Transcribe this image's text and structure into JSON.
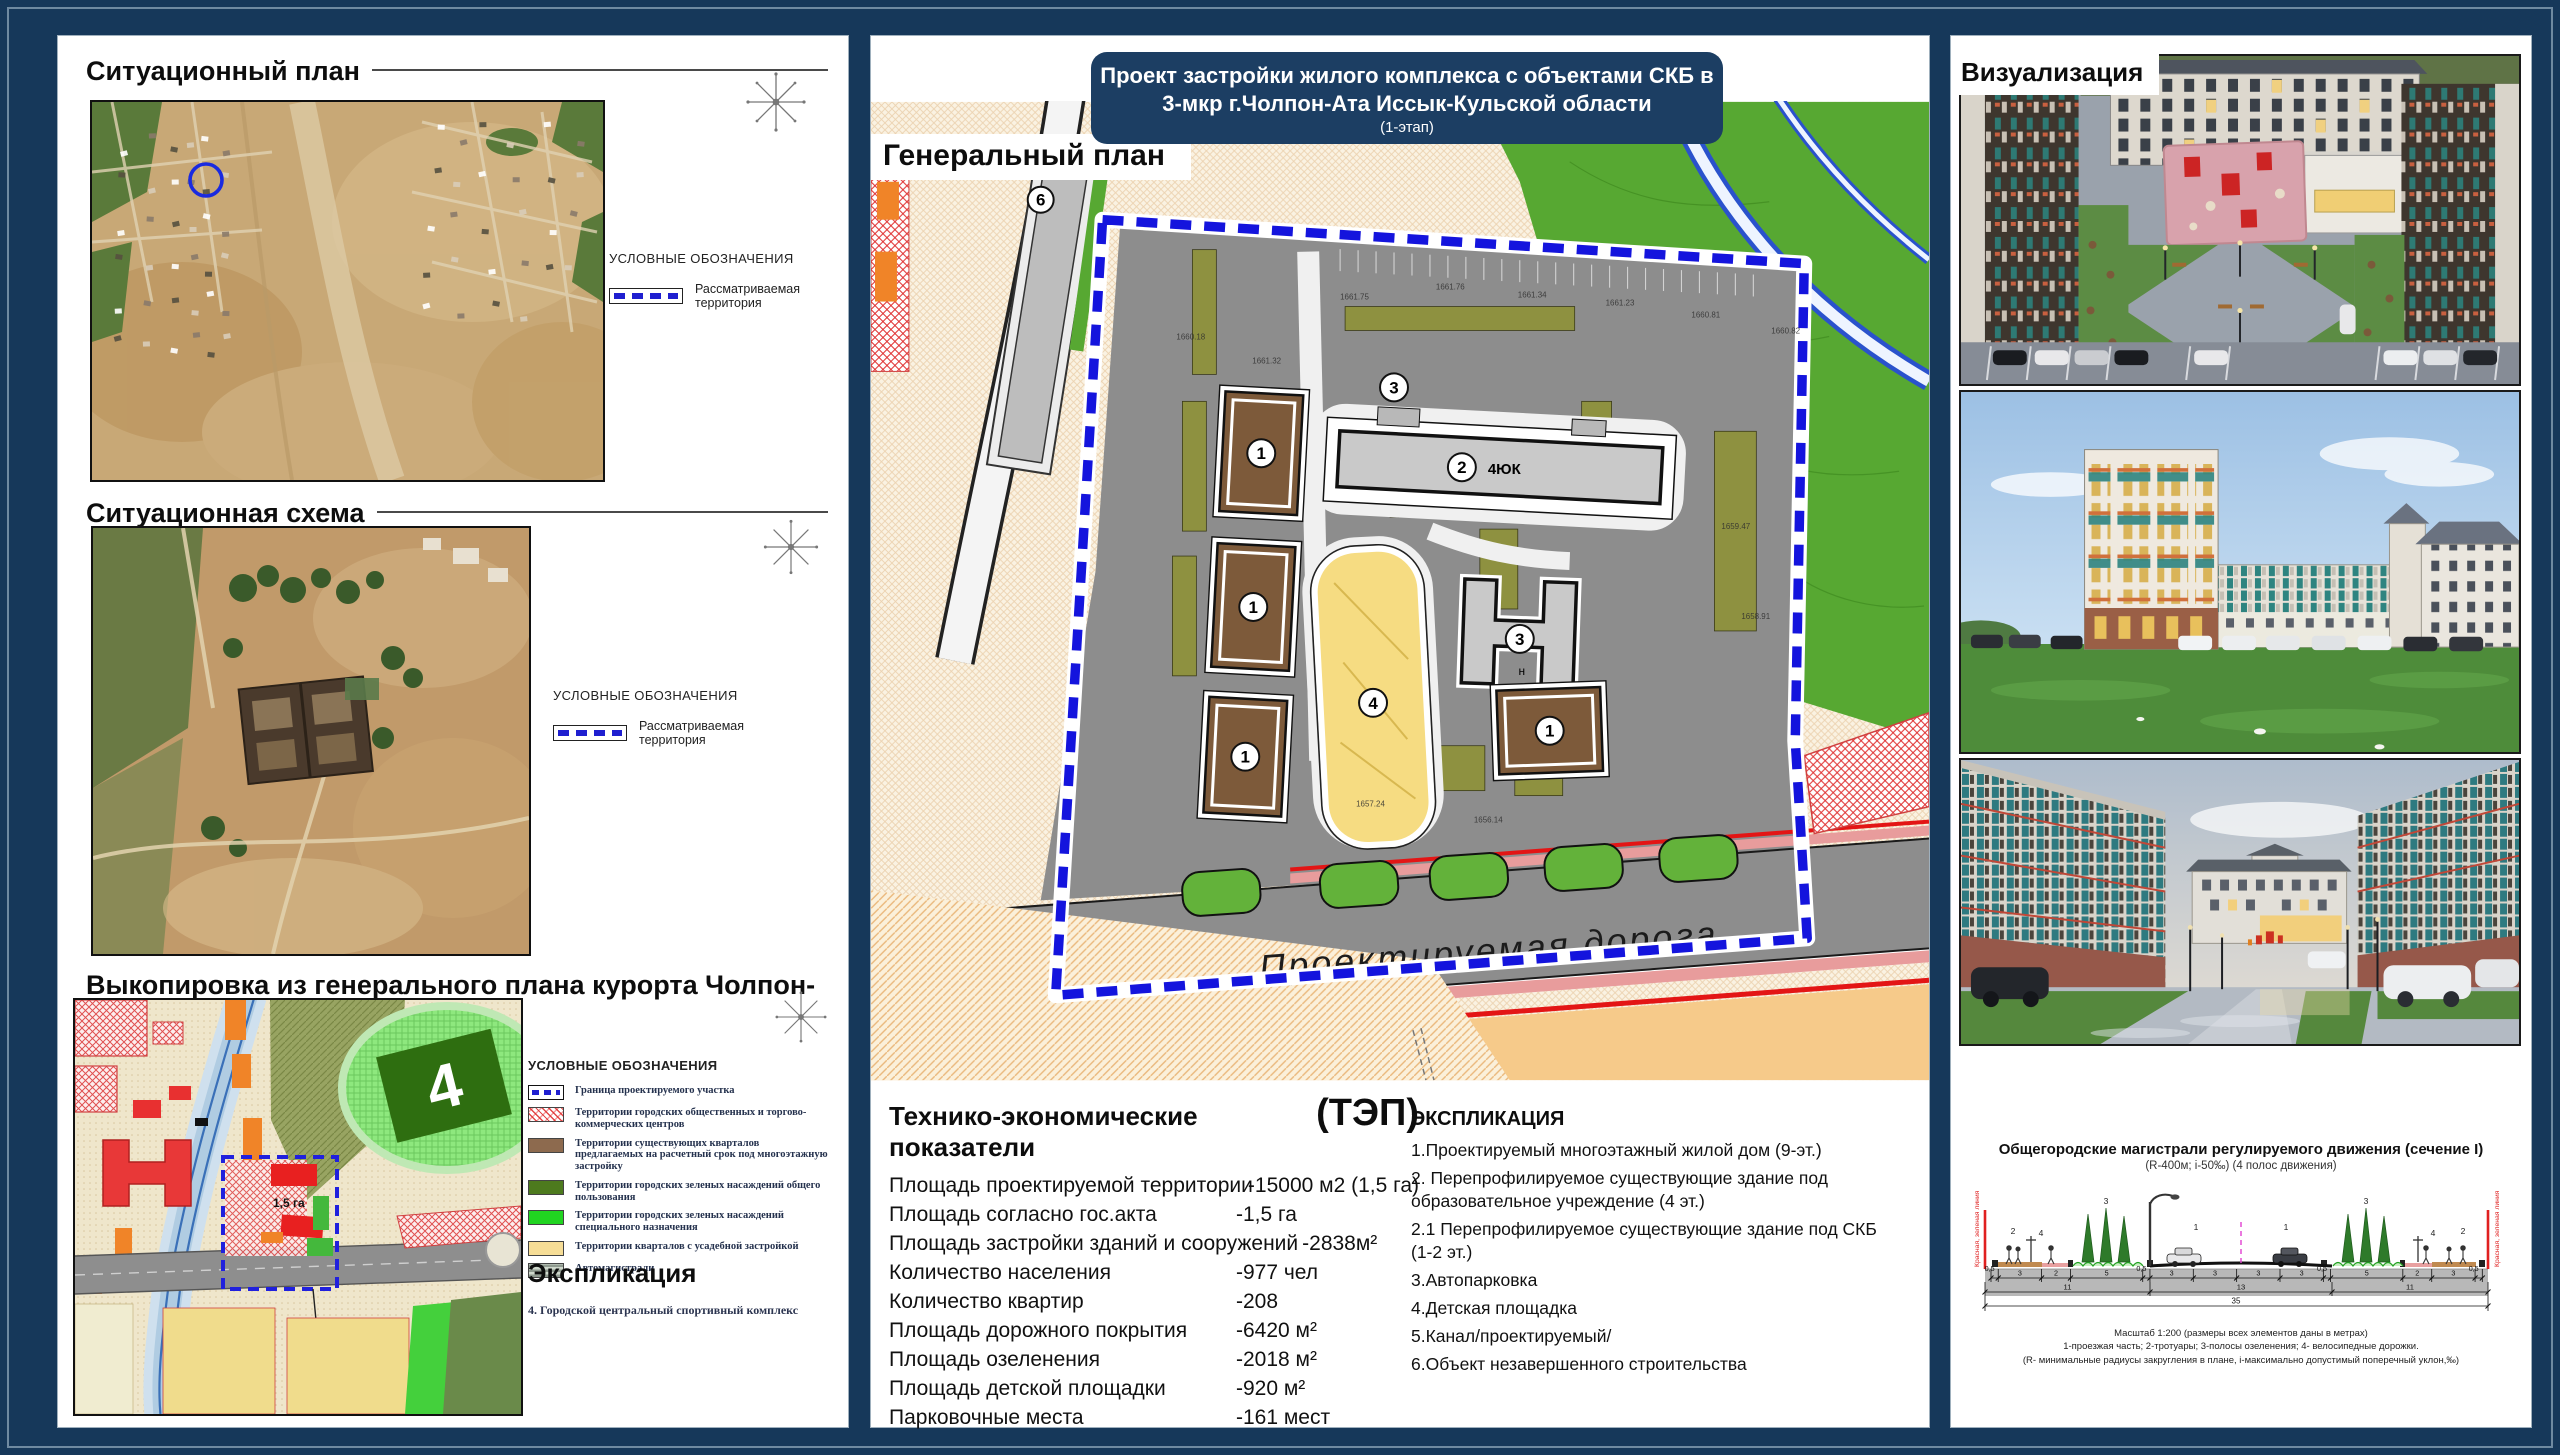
{
  "colors": {
    "board_bg": "#16385a",
    "title_bg": "#1c3e63",
    "boundary_blue": "#1a1add",
    "red_line": "#e31515",
    "site_gray": "#8d8d8d",
    "green_zone": "#57a832",
    "building_brown": "#7d5a3a",
    "playground_yellow": "#f6dc82"
  },
  "left": {
    "situational_plan": {
      "title": "Ситуационный план",
      "legend_title": "УСЛОВНЫЕ ОБОЗНАЧЕНИЯ",
      "legend_item": "Рассматриваемая территория"
    },
    "situational_scheme": {
      "title": "Ситуационная схема",
      "legend_title": "УСЛОВНЫЕ ОБОЗНАЧЕНИЯ",
      "legend_item": "Рассматриваемая территория"
    },
    "master_plan_extract": {
      "title": "Выкопировка из генерального плана курорта Чолпон-Ата",
      "legend_title": "УСЛОВНЫЕ  ОБОЗНАЧЕНИЯ",
      "legend_items": [
        {
          "swatch": "boundary",
          "label": "Граница проектируемого участка"
        },
        {
          "swatch": "red-hatch",
          "label": "Территории городских общественных и торгово-коммерческих центров"
        },
        {
          "swatch": "brown",
          "label": "Территории существующих кварталов предлагаемых на расчетный срок под многоэтажную застройку"
        },
        {
          "swatch": "dark-green",
          "label": "Территории городских зеленых насаждений общего пользования"
        },
        {
          "swatch": "bright-green",
          "label": "Территории городских зеленых насаждений специального назначения"
        },
        {
          "swatch": "pale-yellow",
          "label": "Территории кварталов с усадебной застройкой"
        },
        {
          "swatch": "highway",
          "label": "Автомагистрали"
        }
      ],
      "explication_title": "Экспликация",
      "explication_item": "4.  Городской центральный спортивный комплекс",
      "stadium_number": "4",
      "site_area_label": "1,5 га"
    }
  },
  "center": {
    "title": {
      "line1": "Проект застройки жилого комплекса с объектами СКБ в",
      "line2": "3-мкр г.Чолпон-Ата  Иссык-Кульской области",
      "line3": "(1-этап)"
    },
    "plan_label": "Генеральный план",
    "plan": {
      "road_label": "Проектируемая  дорога",
      "b1": "1",
      "b2": "2",
      "b2_wing": "4ЮК",
      "b3": "3",
      "b3_note": "н",
      "b4": "4",
      "b6": "6",
      "point_a": "А",
      "elevation_marks": [
        "1661.75",
        "1661.76",
        "1661.34",
        "1661.23",
        "1660.81",
        "1660.82",
        "1660.18",
        "1661.32",
        "1659.47",
        "1658.91",
        "1657.24",
        "1656.14"
      ]
    },
    "tep": {
      "title": "Технико-экономические показатели",
      "abbr": "(ТЭП)",
      "rows": [
        {
          "label": "Площадь проектируемой территории",
          "value": "-15000 м2 (1,5 га)"
        },
        {
          "label": "Площадь согласно гос.акта",
          "value": "-1,5 га"
        },
        {
          "label": "Площадь застройки зданий и сооружений",
          "value": "-2838м²"
        },
        {
          "label": "Количество населения",
          "value": "-977 чел"
        },
        {
          "label": "Количество квартир",
          "value": "-208"
        },
        {
          "label": "Площадь дорожного покрытия",
          "value": " -6420 м²"
        },
        {
          "label": "Площадь озеленения",
          "value": "-2018 м²"
        },
        {
          "label": "Площадь детской площадки",
          "value": "-920 м²"
        },
        {
          "label": "Парковочные места",
          "value": "-161 мест"
        }
      ]
    },
    "explication": {
      "title": "ЭКСПЛИКАЦИЯ",
      "items": [
        "1.Проектируемый многоэтажный жилой дом (9-эт.)",
        "2.  Перепрофилируемое существующие здание под образовательное учреждение (4 эт.)",
        "2.1 Перепрофилируемое существующие здание под СКБ (1-2 эт.)",
        "3.Автопарковка",
        "4.Детская площадка",
        "5.Канал/проектируемый/",
        "6.Объект незавершенного строительства"
      ]
    }
  },
  "right": {
    "title": "Визуализация",
    "cross_section": {
      "title": "Общегородские магистрали регулируемого движения (сечение I)",
      "subtitle": "(R-400м; i-50‰) (4 полос движения)",
      "red_line_label": "Красная, зеленая линия",
      "markers_left": [
        "2",
        "4",
        "3",
        "1"
      ],
      "markers_right": [
        "1",
        "3",
        "4",
        "2"
      ],
      "dims_row1": [
        "0,5",
        "3",
        "2",
        "5",
        "0,5",
        "3",
        "3",
        "3",
        "3",
        "0,5",
        "5",
        "2",
        "3",
        "0,5"
      ],
      "dims_row2": [
        "11",
        "13",
        "11"
      ],
      "dims_total": "35",
      "caption1": "Масштаб 1:200 (размеры всех элементов даны в метрах)",
      "caption2": "1-проезжая часть; 2-тротуары; 3-полосы озеленения; 4- велосипедные дорожки.",
      "caption3": "(R- минимальные радиусы закругления в плане, i-максимально допустимый поперечный уклон,‰)"
    }
  }
}
